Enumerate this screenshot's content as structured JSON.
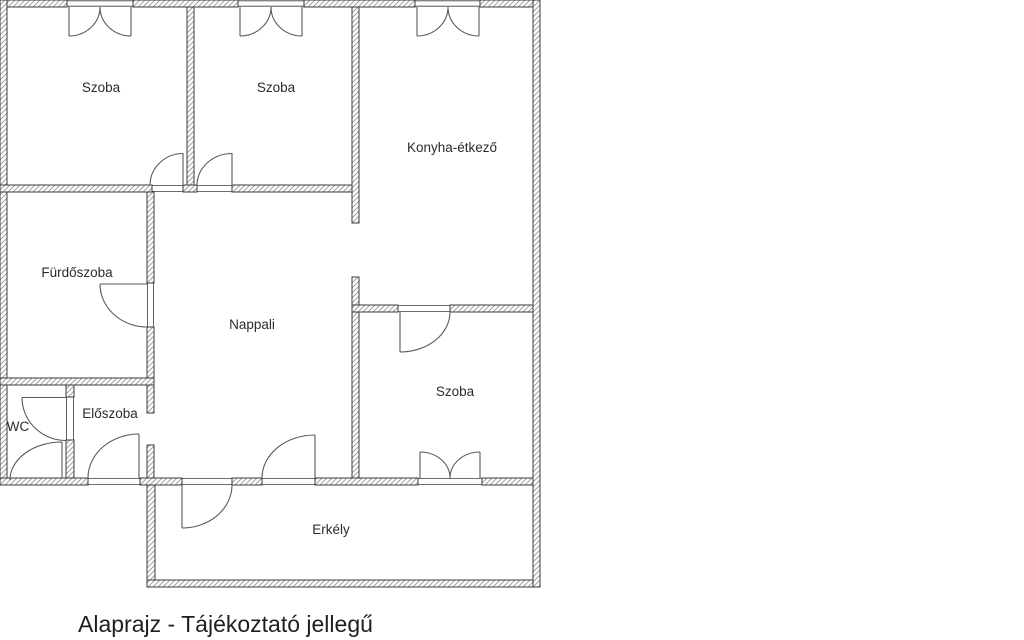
{
  "floor_plan": {
    "labels": {
      "szoba1": "Szoba",
      "szoba2": "Szoba",
      "konyha": "Konyha-étkező",
      "furdoszoba": "Fürdőszoba",
      "nappali": "Nappali",
      "szoba3": "Szoba",
      "wc": "WC",
      "eloszoba": "Előszoba",
      "erkely": "Erkély"
    },
    "caption": "Alaprajz - Tájékoztató jellegű",
    "colors": {
      "wall_line": "#3b3b3b",
      "hatch_line": "#999999",
      "door_line": "#5a5a5a",
      "text": "#2b2b2b",
      "background": "#ffffff"
    }
  }
}
